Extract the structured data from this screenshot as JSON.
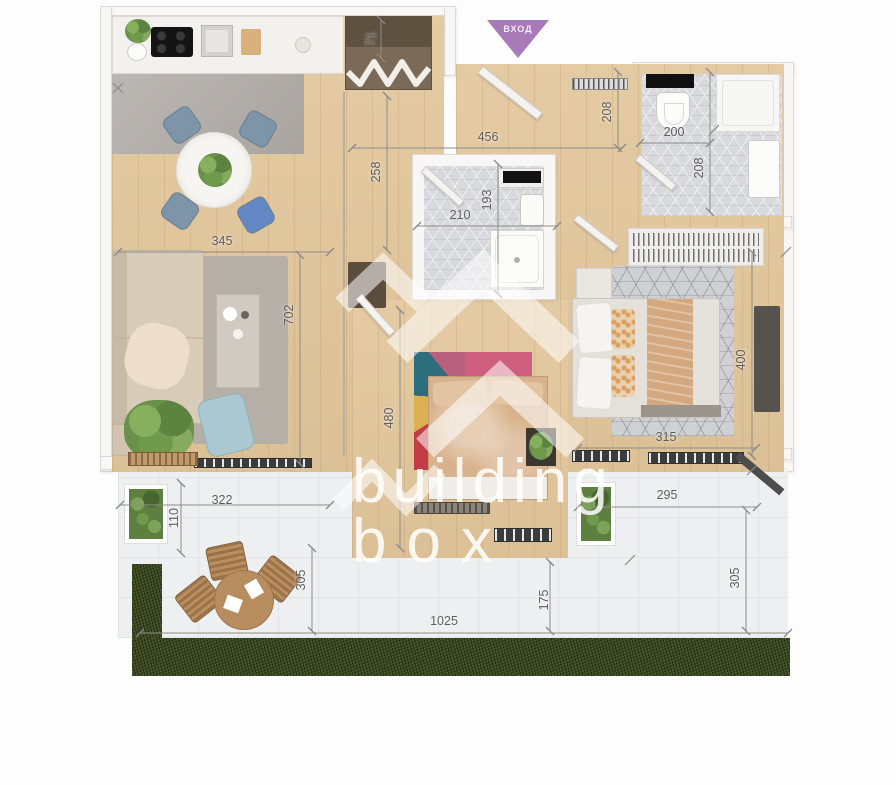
{
  "entrance": {
    "label": "ВХОД",
    "color": "#a87ab8"
  },
  "watermark": {
    "line1": "building",
    "line2": "box"
  },
  "dimensions": {
    "closet_depth": "71",
    "hallway_width": "456",
    "hallway_height": "208",
    "bath_top_width": "200",
    "bath_top_height": "208",
    "hallway_left_height": "258",
    "bath_mid_width": "210",
    "bath_mid_height": "193",
    "living_width": "345",
    "living_height": "702",
    "bedroom_mid_height": "480",
    "bedroom_right_height": "400",
    "bedroom_right_width": "315",
    "terrace_left_width": "322",
    "terrace_left_depth": "110",
    "terrace_left_height": "305",
    "terrace_mid_height": "175",
    "terrace_right_width": "295",
    "terrace_right_height": "305",
    "total_width": "1025"
  },
  "colors": {
    "wood": "#e3c89e",
    "grass": "#3b4823",
    "accent_purple": "#a87ab8"
  }
}
